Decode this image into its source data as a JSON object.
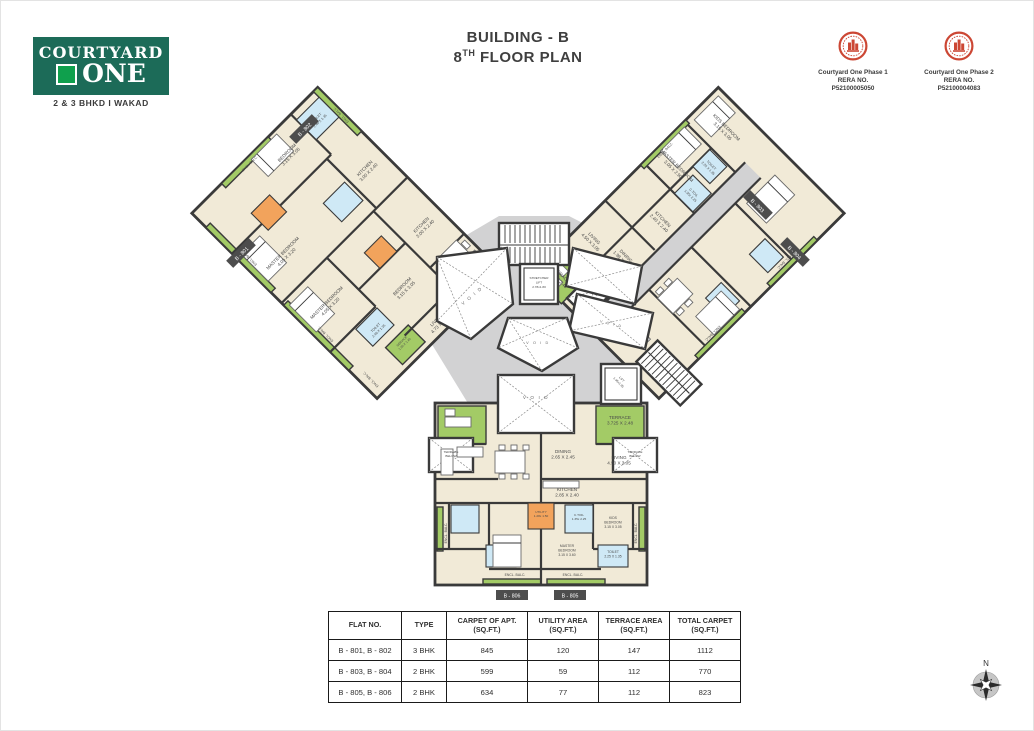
{
  "brand": {
    "name_top": "COURTYARD",
    "name_bottom": "ONE",
    "tagline": "2 & 3 BHKD  I  WAKAD"
  },
  "title": {
    "line1": "BUILDING - B",
    "floor_num": "8",
    "floor_sup": "TH",
    "floor_rest": " FLOOR PLAN"
  },
  "rera": [
    {
      "project": "Courtyard One Phase 1",
      "label": "RERA NO.",
      "number": "P52100005050"
    },
    {
      "project": "Courtyard One Phase 2",
      "label": "RERA NO.",
      "number": "P52100004083"
    }
  ],
  "colors": {
    "brand_green": "#1c6b58",
    "brand_square": "#0fa04d",
    "seal_red": "#cc4734",
    "room_cream": "#f1ead7",
    "balcony_green": "#a3cb66",
    "toilet_blue": "#cfe9f6",
    "utility_orange": "#f2a35c",
    "corridor_gray": "#d2d2d3",
    "wall": "#3a3a3a"
  },
  "plan": {
    "core": {
      "up": "UP",
      "stretcher": [
        "STRETCHER",
        "LIFT",
        "2.78x1.80"
      ],
      "lift": [
        "LIFT",
        "1.95x1.95"
      ],
      "void_label": "V O I D",
      "terrace_below": [
        "TERRACE",
        "BELOW"
      ]
    },
    "tags": {
      "b801": "B - 801",
      "b802": "B - 802",
      "b803": "B - 803",
      "b804": "B - 804",
      "b805": "B - 805",
      "b806": "B - 806"
    },
    "wing_left": {
      "encl": "ENCL. BALC.",
      "rooms": {
        "master": {
          "name": "MASTER BEDROOM",
          "dim": "4.05 X 3.20"
        },
        "toilet": {
          "name": "TOILET",
          "dim": "2.40 X 1.35"
        },
        "bedroom": {
          "name": "BEDROOM",
          "dim": "3.15 X 3.05"
        },
        "kitchen": {
          "name": "KITCHEN",
          "dim": "3.00 X 2.40"
        },
        "dining": {
          "name": "DINING",
          "dim": "2.65 X 2.45"
        },
        "living": {
          "name": "LIVING",
          "dim": "4.73 X 3.30"
        },
        "service": {
          "name": "SERVICE",
          "dim": "1.50 X 1.40"
        }
      }
    },
    "wing_right": {
      "encl": "ENCL. BALC.",
      "rooms": {
        "kids": {
          "name": "KIDS BEDROOM",
          "dim": "3.15 X 3.05"
        },
        "toilet": {
          "name": "TOILET",
          "dim": "2.25 X 1.35"
        },
        "master": {
          "name": "MASTER BEDROOM",
          "dim": "3.05 X 2.90"
        },
        "ctoil": {
          "name": "C.TOIL",
          "dim": "1.35x 2.25"
        },
        "kitchen": {
          "name": "KITCHEN",
          "dim": "2.40 X 2.40"
        },
        "dining": {
          "name": "DINING",
          "dim": "1.98 X 2.45"
        },
        "living": {
          "name": "LIVING",
          "dim": "4.50 X 3.05"
        },
        "terrace": {
          "name": "TERRACE",
          "dim": "3.725 X 2.48"
        }
      }
    },
    "wing_bottom": {
      "encl": "ENCL. BALC.",
      "rooms": {
        "terrace": {
          "name": "TERRACE",
          "dim": "3.725 X 2.48"
        },
        "dining": {
          "name": "DINING",
          "dim": "2.65 X 2.45"
        },
        "living": {
          "name": "LIVING",
          "dim": "4.50 X 3.05"
        },
        "kitchen": {
          "name": "KITCHEN",
          "dim": "2.85 X 2.40"
        },
        "utility": {
          "name": "UTILITY",
          "dim": "1.28x 1.50"
        },
        "ctoil": {
          "name": "C.TOIL",
          "dim": "1.35x 2.25"
        },
        "kids": {
          "name": "KIDS",
          "name2": "BEDROOM",
          "dim": "3.15 X 3.05"
        },
        "master": {
          "name": "MASTER",
          "name2": "BEDROOM",
          "dim": "3.15 X 3.60"
        },
        "toilet": {
          "name": "TOILET",
          "dim": "2.25 X 1.35"
        }
      }
    }
  },
  "compass": {
    "label": "N"
  },
  "table": {
    "headers": [
      {
        "l1": "FLAT NO.",
        "l2": ""
      },
      {
        "l1": "TYPE",
        "l2": ""
      },
      {
        "l1": "CARPET OF APT.",
        "l2": "(SQ.FT.)"
      },
      {
        "l1": "UTILITY AREA",
        "l2": "(SQ.FT.)"
      },
      {
        "l1": "TERRACE AREA",
        "l2": "(SQ.FT.)"
      },
      {
        "l1": "TOTAL CARPET",
        "l2": "(SQ.FT.)"
      }
    ],
    "rows": [
      [
        "B - 801, B - 802",
        "3 BHK",
        "845",
        "120",
        "147",
        "1112"
      ],
      [
        "B - 803, B - 804",
        "2 BHK",
        "599",
        "59",
        "112",
        "770"
      ],
      [
        "B - 805, B - 806",
        "2 BHK",
        "634",
        "77",
        "112",
        "823"
      ]
    ]
  }
}
